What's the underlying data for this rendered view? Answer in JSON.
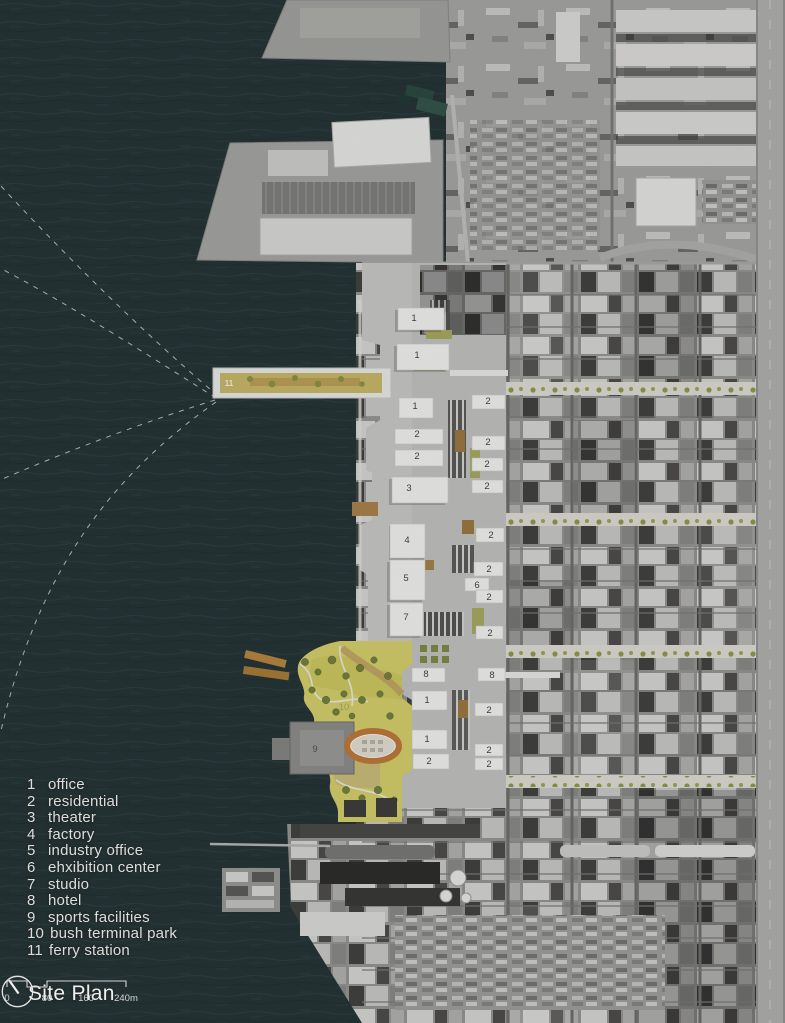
{
  "title_block": {
    "title": "Site Plan"
  },
  "scale_bar": {
    "labels": [
      "0",
      "80",
      "160",
      "240m"
    ]
  },
  "legend": {
    "items": [
      {
        "num": "1",
        "label": "office"
      },
      {
        "num": "2",
        "label": "residential"
      },
      {
        "num": "3",
        "label": "theater"
      },
      {
        "num": "4",
        "label": "factory"
      },
      {
        "num": "5",
        "label": "industry office"
      },
      {
        "num": "6",
        "label": "ehxibition center"
      },
      {
        "num": "7",
        "label": "studio"
      },
      {
        "num": "8",
        "label": "hotel"
      },
      {
        "num": "9",
        "label": "sports facilities"
      },
      {
        "num": "10",
        "label": "bush terminal park"
      },
      {
        "num": "11",
        "label": "ferry station"
      }
    ]
  },
  "map": {
    "annotations": [
      {
        "n": "1"
      },
      {
        "n": "1"
      },
      {
        "n": "1"
      },
      {
        "n": "2"
      },
      {
        "n": "2"
      },
      {
        "n": "3"
      },
      {
        "n": "4"
      },
      {
        "n": "5"
      },
      {
        "n": "7"
      },
      {
        "n": "8"
      },
      {
        "n": "1"
      },
      {
        "n": "1"
      },
      {
        "n": "2"
      },
      {
        "n": "2"
      },
      {
        "n": "2"
      },
      {
        "n": "2"
      },
      {
        "n": "2"
      },
      {
        "n": "2"
      },
      {
        "n": "2"
      },
      {
        "n": "6"
      },
      {
        "n": "2"
      },
      {
        "n": "2"
      },
      {
        "n": "8"
      },
      {
        "n": "2"
      },
      {
        "n": "2"
      },
      {
        "n": "2"
      },
      {
        "n": "9"
      },
      {
        "n": "10"
      },
      {
        "n": "11"
      }
    ],
    "colors": {
      "water": "#273637",
      "urban_gray": "#969694",
      "plan_building": "#f2f2f0",
      "park_yellow": "#d6d06c",
      "avenue_trees": "#93a050",
      "track_orange": "#bf7a3c",
      "pier_tan": "#b5863f"
    }
  }
}
